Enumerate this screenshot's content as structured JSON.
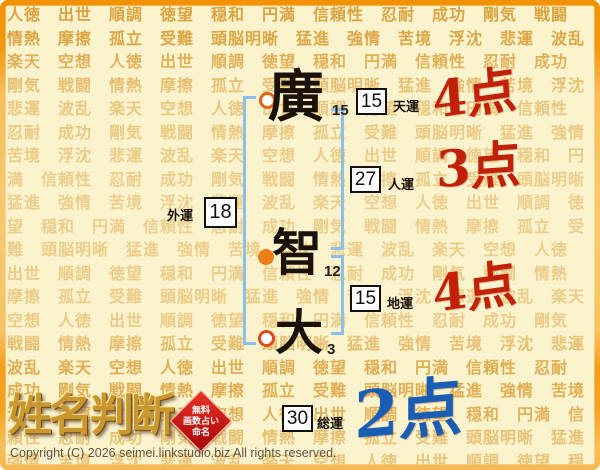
{
  "page": {
    "background_color": "#fbf3cd",
    "border_color": "#f29200"
  },
  "background_pattern": {
    "words": [
      "人徳",
      "出世",
      "順調",
      "徳望",
      "穏和",
      "円満",
      "信頼性",
      "忍耐",
      "成功",
      "剛気",
      "戦闘",
      "情熱",
      "摩擦",
      "孤立",
      "受難",
      "頭脳明晰",
      "猛進",
      "強情",
      "苦境",
      "浮沈",
      "悲運",
      "波乱",
      "楽天",
      "空想"
    ],
    "color": "#dca23e"
  },
  "name": {
    "characters": [
      {
        "char": "廣",
        "strokes": "15",
        "marker": "ring"
      },
      {
        "char": "智",
        "strokes": "12",
        "marker": "dot"
      },
      {
        "char": "大",
        "strokes": "3",
        "marker": "ring"
      }
    ]
  },
  "fortunes": {
    "tenun": {
      "label": "天運",
      "value": "15",
      "score": "4点"
    },
    "jinun": {
      "label": "人運",
      "value": "27",
      "score": "3点"
    },
    "gaiun": {
      "label": "外運",
      "value": "18"
    },
    "chiun": {
      "label": "地運",
      "value": "15",
      "score": "4点"
    },
    "soun": {
      "label": "総運",
      "value": "30",
      "score": "2点"
    }
  },
  "colors": {
    "score_red": "#c32008",
    "score_blue": "#1a5db5",
    "bracket_blue": "#8cc0ec",
    "marker_orange": "#ee7d15",
    "ring_orange": "#e2611b",
    "ring_red": "#dd4a20"
  },
  "logo": {
    "title": "姓名判断",
    "stamp_lines": [
      "無料",
      "画数占い",
      "命名"
    ]
  },
  "footer": {
    "copyright": "Copyright (C) 2026 seimei.linkstudio.biz All rights reserved."
  }
}
